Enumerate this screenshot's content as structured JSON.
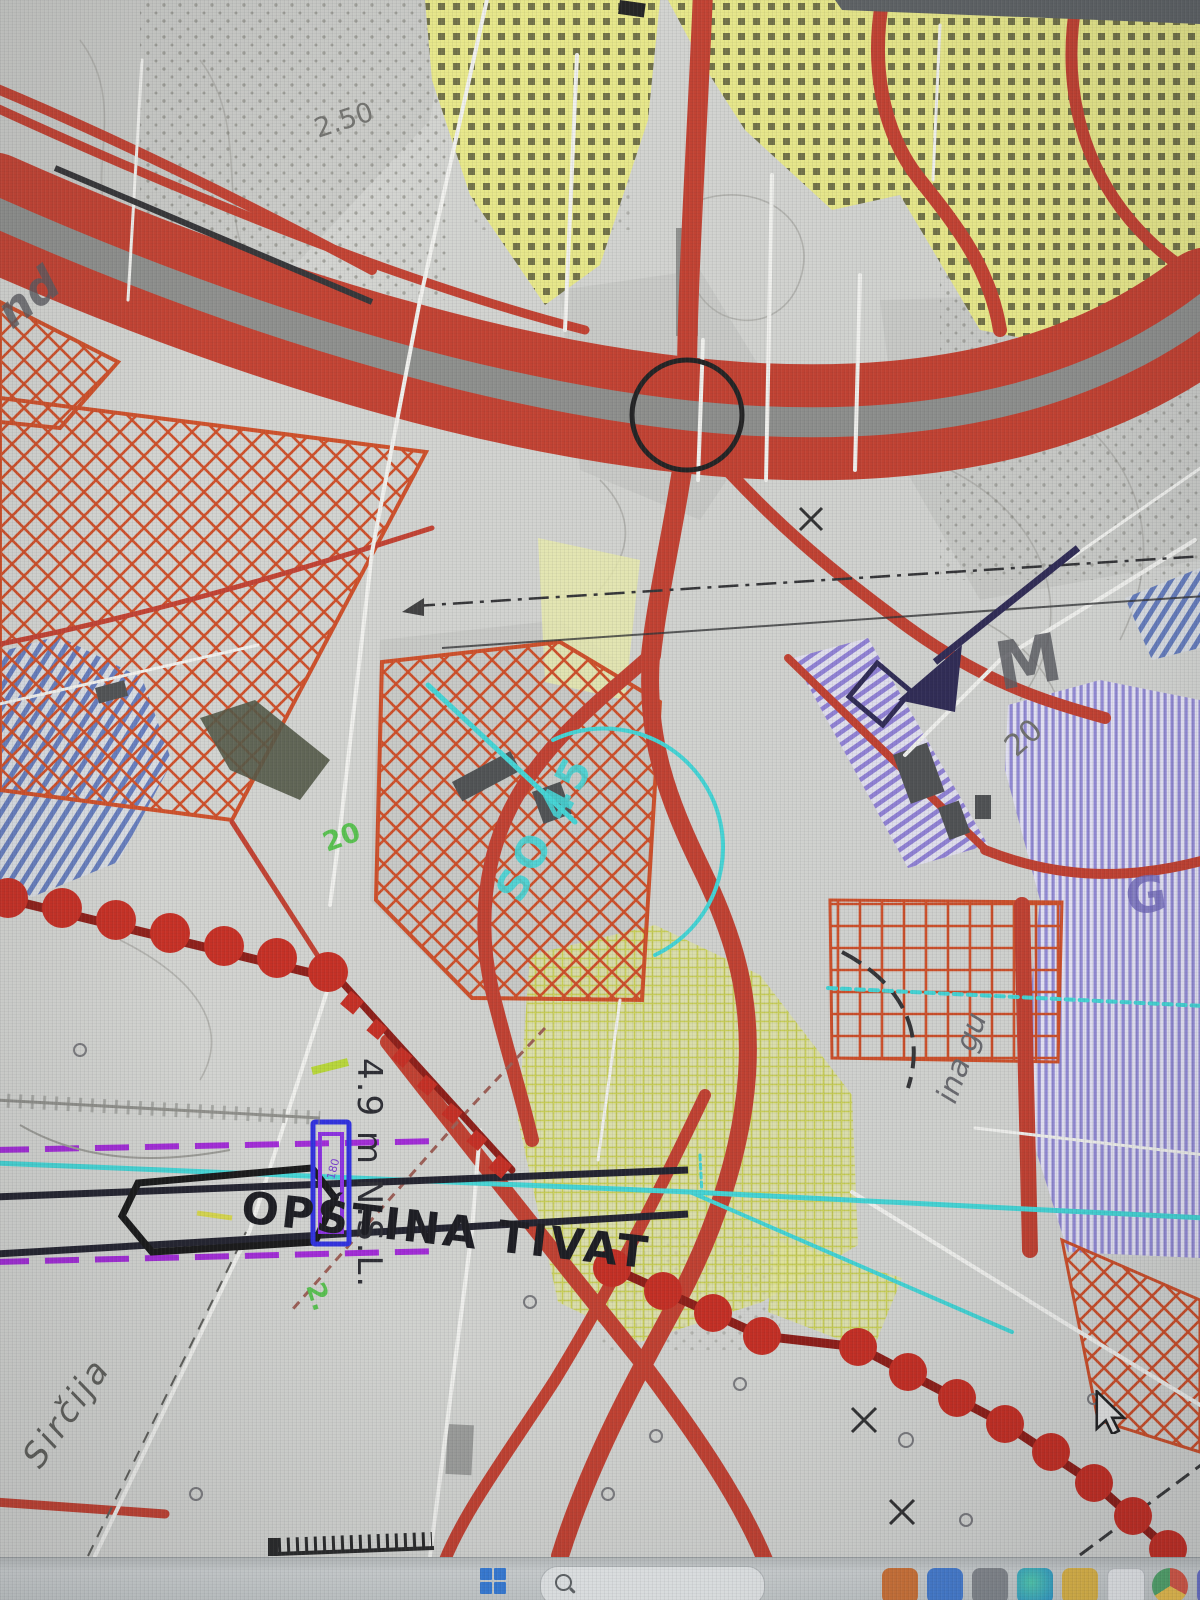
{
  "map": {
    "labels": {
      "municipality": "OPŠTINA TIVAT",
      "road_sircija": "Sirčija",
      "elevation": "4.9 m N.S.L.",
      "contour_250": "2.50",
      "contour_20": "20",
      "spot_20_green": "20",
      "spot_2_green": "2.",
      "letter_m": "M",
      "letter_g": "G",
      "fragment_nd": "nd",
      "fragment_ina_gu": "ina gu",
      "cyan_code": "SO 45",
      "parcel_code": "180"
    },
    "colors": {
      "background": "#d3d4d0",
      "road_red": "#c23b2a",
      "highway_median_gray": "#8b8c89",
      "boundary_dot_red": "#c6281c",
      "boundary_line_red": "#8c1710",
      "crosshatch_red": "#cf4a22",
      "zone_yellow": "#e9e986",
      "zone_purple": "#9188d5",
      "zone_blue_hatch": "#5570b8",
      "cyan": "#3fd6d6",
      "magenta_dashed": "#a124d8",
      "parcel_blue": "#2a2ae0",
      "parcel_purple": "#8a2be2",
      "circle_black": "#1b1b1b",
      "arrow_navy": "#2a2550"
    }
  },
  "taskbar": {
    "apps": [
      "app-orange",
      "app-blue",
      "app-gray",
      "app-teal",
      "app-yellow",
      "app-document",
      "app-chrome",
      "app-purple"
    ]
  },
  "cursor": {
    "visible": true
  }
}
